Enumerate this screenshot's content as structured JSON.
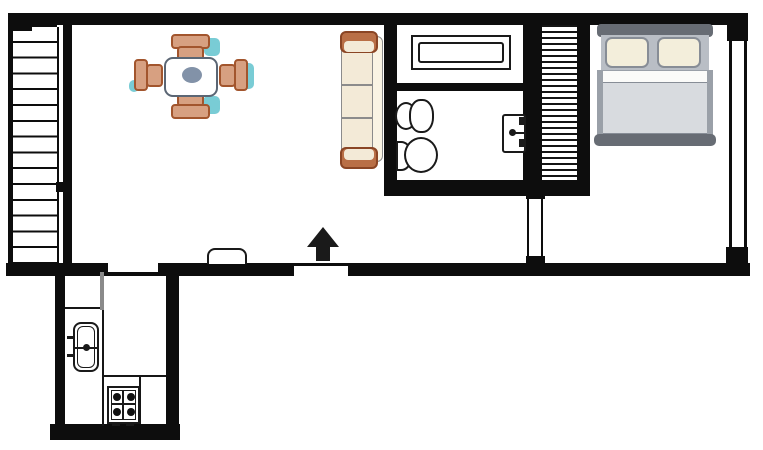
{
  "document": {
    "type": "architectural-floor-plan",
    "visible_text": [],
    "rooms": [
      "living-dining room",
      "bathroom",
      "bedroom",
      "kitchen",
      "staircase",
      "closet"
    ]
  },
  "colors": {
    "wall": "#0d0d0d",
    "floor": "#ffffff",
    "chair-wood": "#d7a081",
    "chair-outline": "#a2552d",
    "accent-shadow": "#79ccd5",
    "table-oval": "#8292a8",
    "sofa-body": "#f3ead7",
    "sofa-arm": "#b96f46",
    "bed-frame": "#676c74",
    "bed-blanket": "#d8dbdf",
    "bed-pillow": "#f3eedb",
    "door-leaf": "#8a8a8a"
  },
  "elements": {
    "staircase": "staircase with treads",
    "closet": "built-in wardrobe (hatched)",
    "dining_table": "square dining table",
    "dining_chair": "dining chair",
    "sofa": "three-seat sofa",
    "bathtub": "bathtub",
    "washbasin": "bathroom washbasin",
    "toilet": "toilet",
    "wall_tap_unit": "wall-mounted unit with tap",
    "bed": "double bed with two pillows",
    "kitchen_sink": "kitchen sink with faucet",
    "stove": "four-burner stove",
    "entrance_arrow": "entrance direction arrow",
    "window": "window in right wall",
    "door_opening": "door opening",
    "door_bump": "door threshold"
  }
}
